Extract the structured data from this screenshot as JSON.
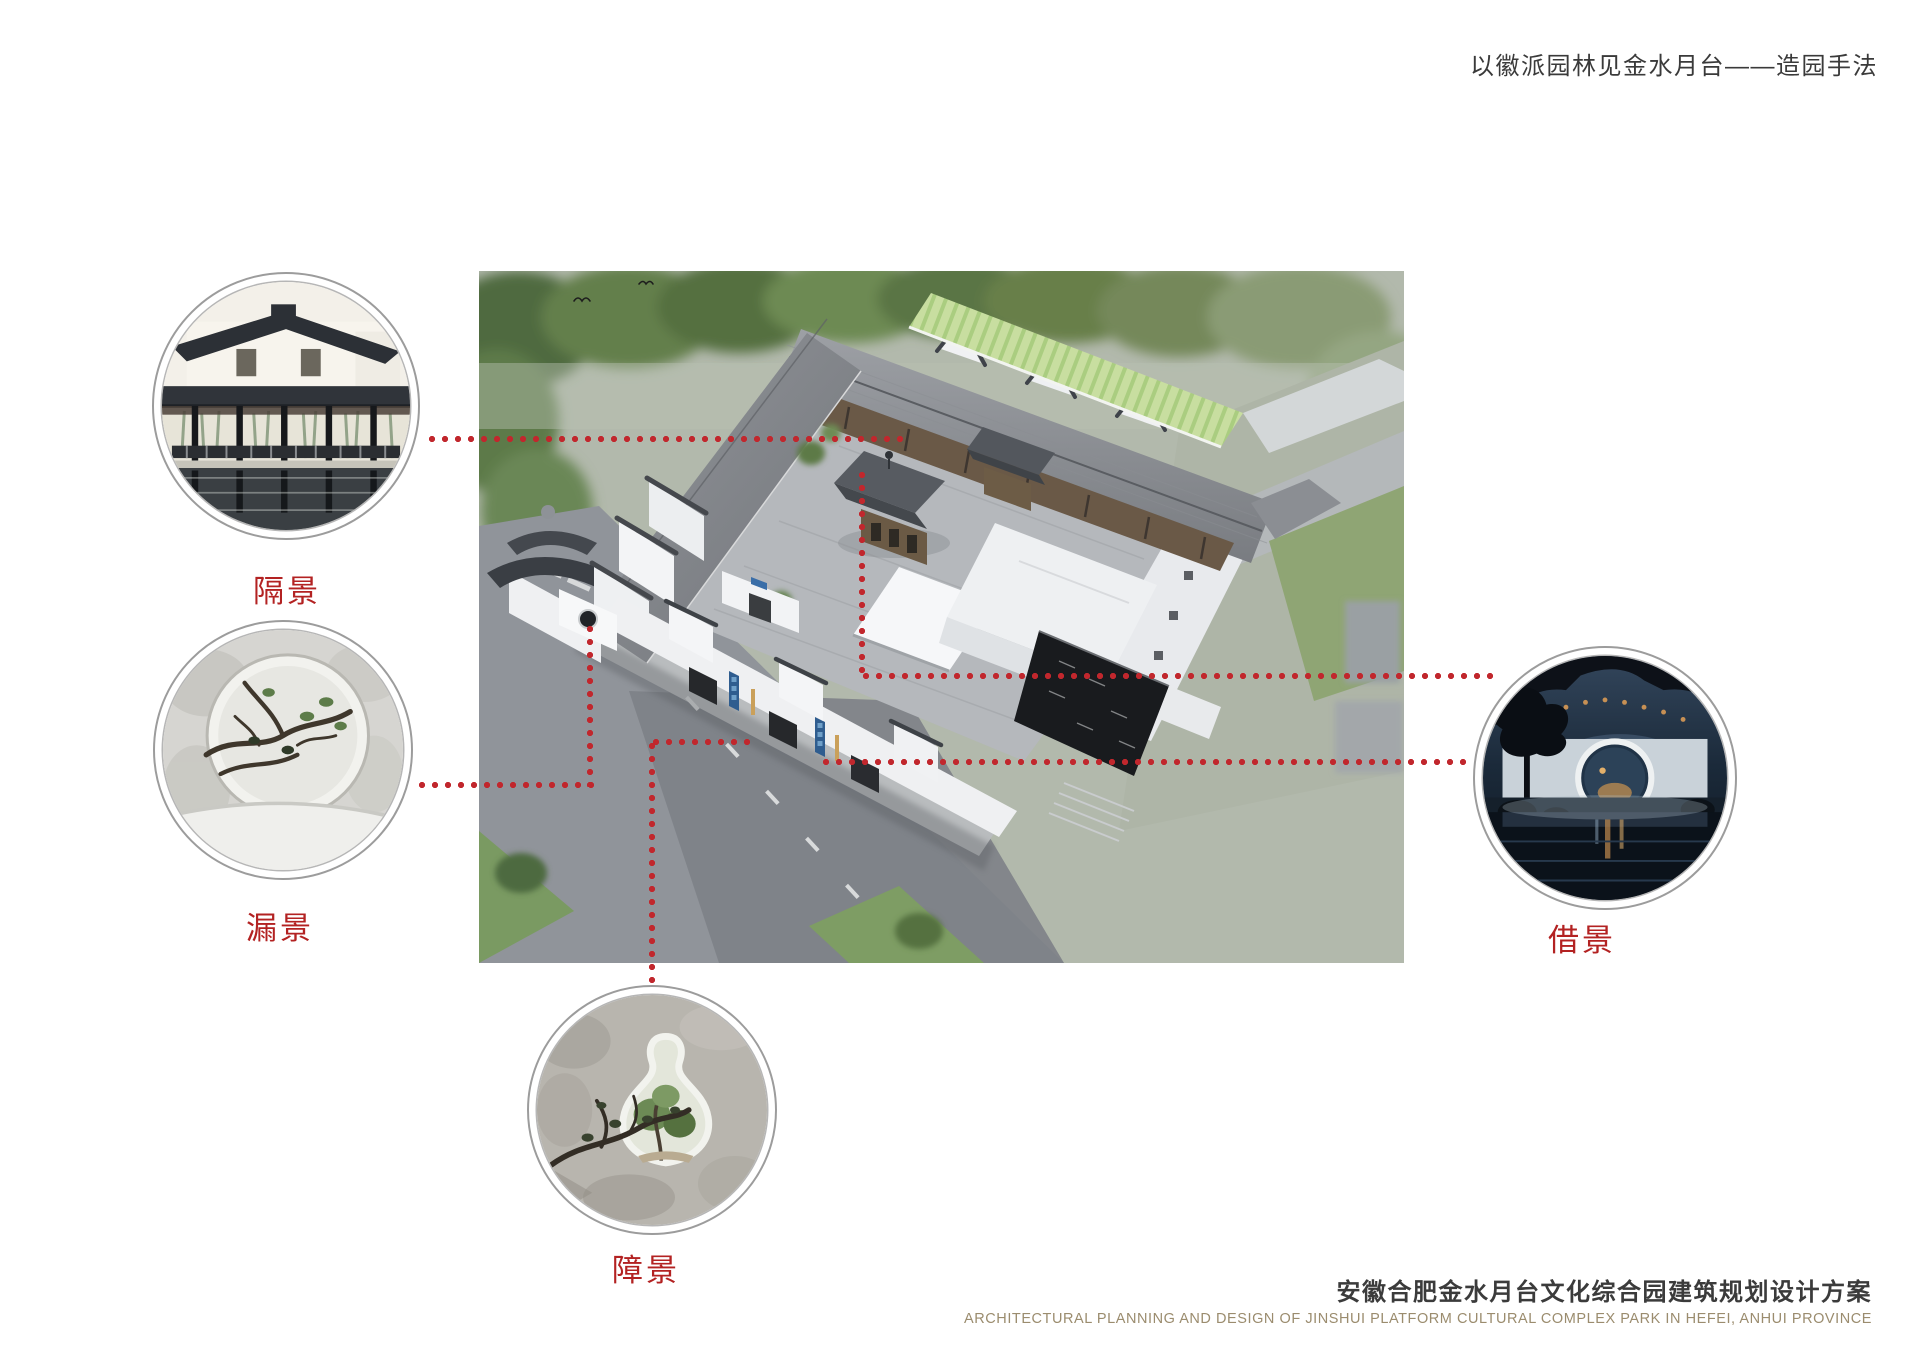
{
  "header": {
    "title": "以徽派园林见金水月台——造园手法"
  },
  "main_image": {
    "name": "aerial-rendering-of-huizhou-style-courtyard-complex"
  },
  "callouts": {
    "gejing": {
      "label": "隔景",
      "image": "covered-corridor-waterside-photo"
    },
    "loujing": {
      "label": "漏景",
      "image": "round-lattice-window-branches-photo"
    },
    "zhangjing": {
      "label": "障景",
      "image": "vase-shaped-doorway-plants-photo"
    },
    "jiejing": {
      "label": "借景",
      "image": "moon-gate-night-courtyard-photo"
    }
  },
  "footer": {
    "title_cn": "安徽合肥金水月台文化综合园建筑规划设计方案",
    "subtitle_en": "ARCHITECTURAL PLANNING AND DESIGN OF JINSHUI PLATFORM CULTURAL COMPLEX PARK IN HEFEI, ANHUI PROVINCE"
  },
  "colors": {
    "connector_red": "#c1272d",
    "label_red": "#b32222",
    "title_gray": "#3a3a3a",
    "footer_en_tan": "#9b8c6e"
  }
}
